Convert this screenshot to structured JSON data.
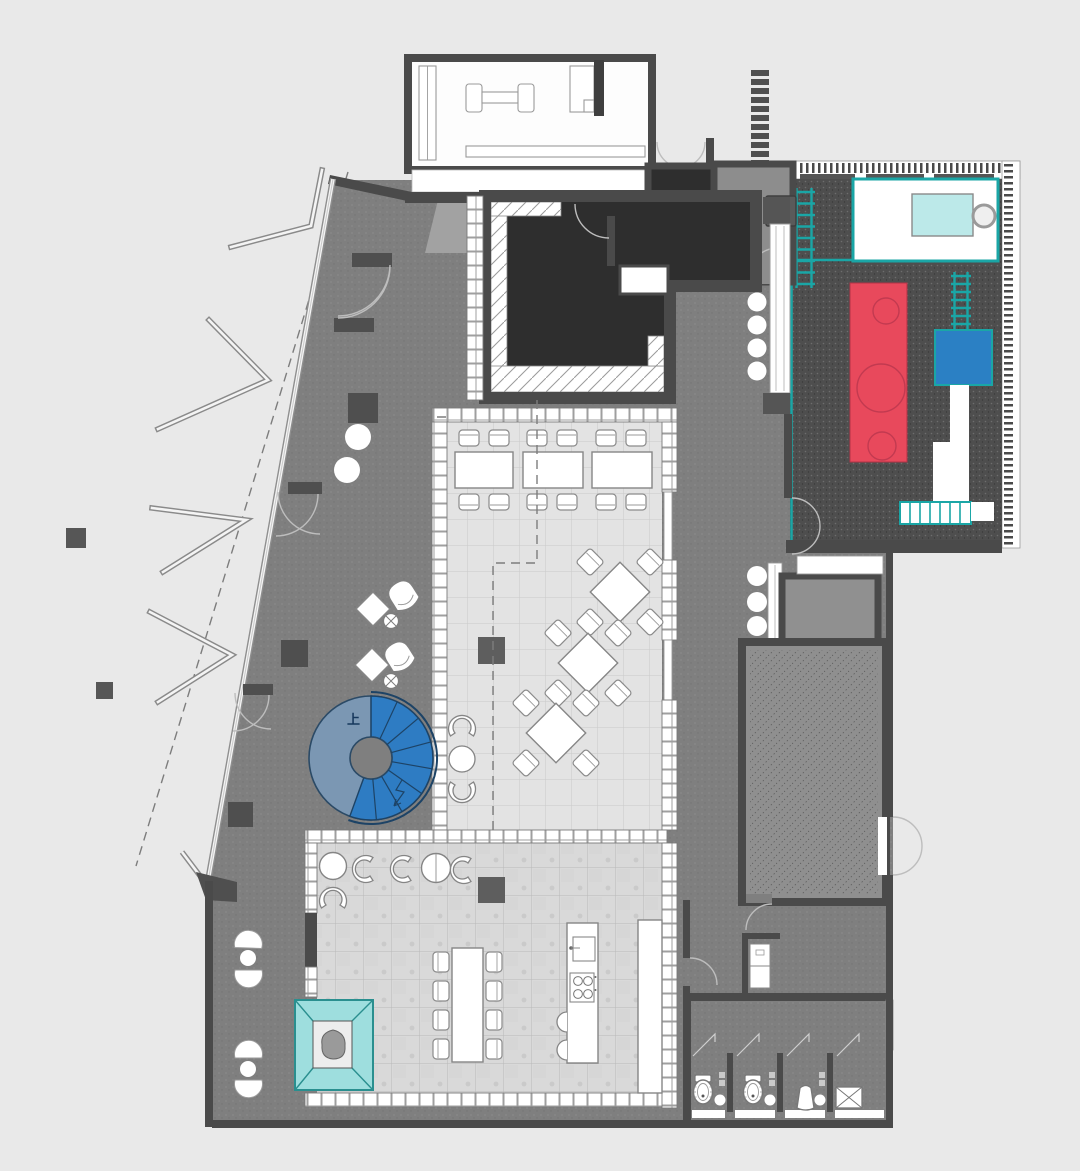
{
  "labels": {
    "stair_up": "上"
  },
  "colors": {
    "background": "#e9e9e9",
    "wall": "#4a4a4a",
    "floor_gray": "#7f7f7f",
    "floor_dark": "#2e2e2e",
    "terrace_dark": "#4e4e4e",
    "tile_light": "#e3e3e3",
    "tile_marble": "#d9d9d9",
    "accent_red": "#e8495c",
    "accent_blue": "#2b80c4",
    "teal": "#1aa6a6",
    "cyan_pale": "#bce9e9",
    "cyan_soft": "#9edede",
    "stair_bright": "#2e7cc3",
    "stair_muted": "#7b97b3"
  },
  "features": [
    "gym-room",
    "dumbbell",
    "fitness-bench",
    "reception-desk",
    "storage-cabinet",
    "entry-double-door",
    "evacuation-ladder-symbol",
    "entry-vestibule",
    "lift-room",
    "dark-lounge-room",
    "glazed-corridor",
    "outdoor-play-terrace",
    "terrace-fence",
    "sand-pit",
    "trampoline",
    "play-ladder",
    "red-play-structure",
    "blue-play-cube",
    "terrace-steps",
    "dining-hall",
    "dining-table",
    "diamond-table",
    "lounge-armchair",
    "side-table",
    "spiral-stair-up",
    "family-dining-table",
    "kitchen-island",
    "bar-counter",
    "teal-canopy-seat",
    "window-seat-nook",
    "hatched-storage-room",
    "restroom-block",
    "toilet",
    "urinal",
    "shower-drain",
    "wash-niche",
    "glass-facade",
    "canopy-fin",
    "canopy-dashed-line",
    "column",
    "planter-circle"
  ]
}
